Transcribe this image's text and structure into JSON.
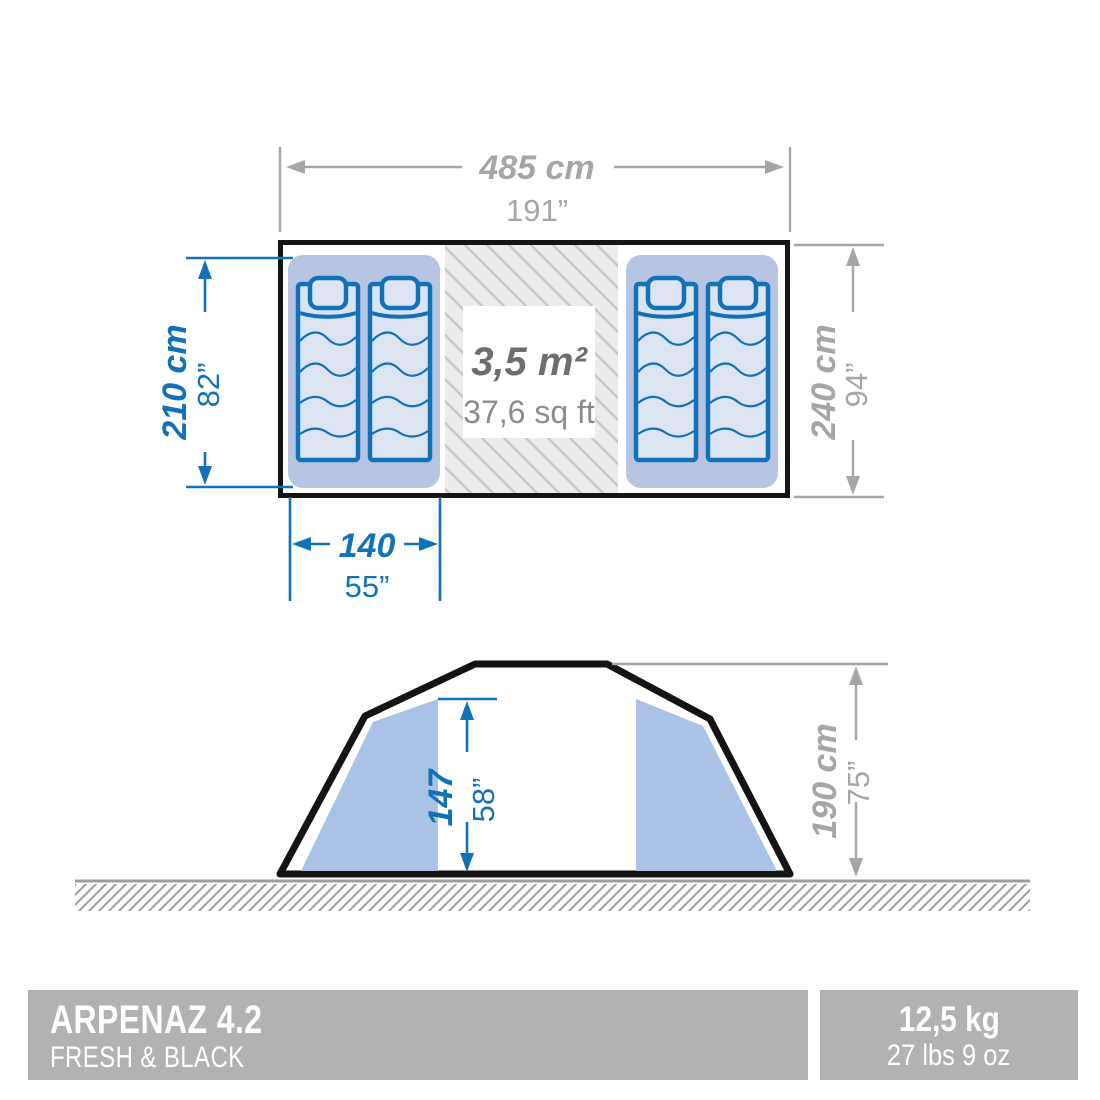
{
  "colors": {
    "blue": "#1272b8",
    "dim_gray": "#a6a6a6",
    "outline": "#141414",
    "compartment_fill": "#b7c5e3",
    "mat_fill": "#dce4f2",
    "panel_fill": "#a9c2e5",
    "hatch_bg": "#ececec",
    "hatch_line": "#c8c8c8",
    "ground": "#9d9d9d",
    "area_text": "#6e6e6e",
    "area_sub": "#8c8c8c",
    "banner_bg": "#b2b2b2"
  },
  "top_view": {
    "width_cm": "485 cm",
    "width_in": "191”",
    "depth_left_cm": "210 cm",
    "depth_left_in": "82”",
    "depth_right_cm": "240 cm",
    "depth_right_in": "94”",
    "bed_width_cm": "140",
    "bed_width_in": "55”",
    "living_area_m2": "3,5 m²",
    "living_area_sqft": "37,6 sq ft"
  },
  "side_view": {
    "interior_height_cm": "147",
    "interior_height_in": "58”",
    "total_height_cm": "190 cm",
    "total_height_in": "75”"
  },
  "banner": {
    "product_name": "ARPENAZ 4.2",
    "product_line": "FRESH & BLACK",
    "weight_kg": "12,5 kg",
    "weight_lbs": "27 lbs 9 oz"
  }
}
